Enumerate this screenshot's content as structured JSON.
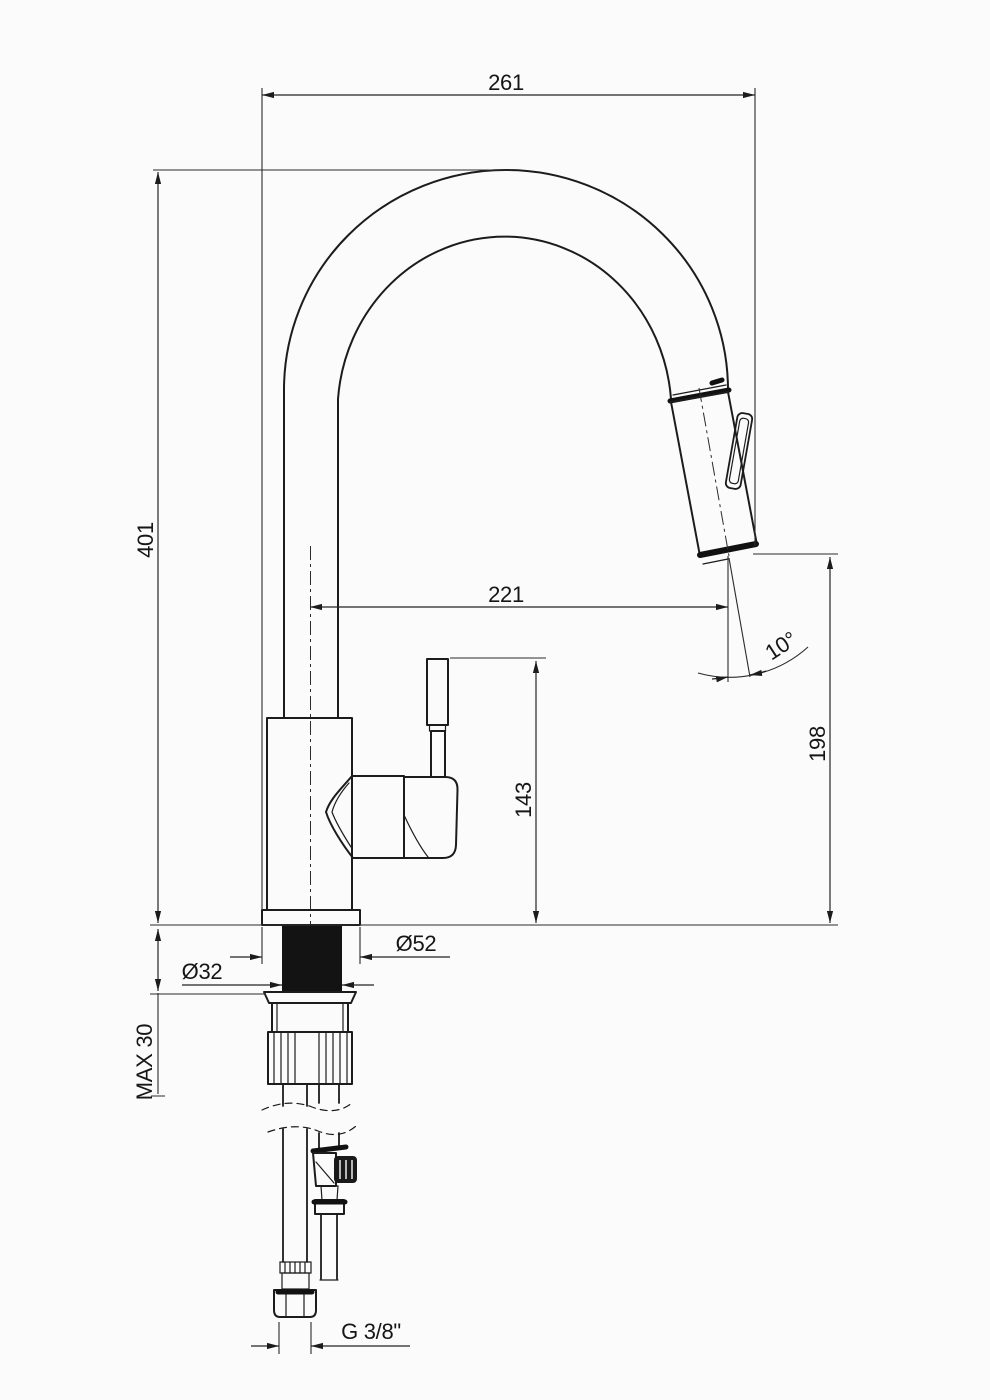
{
  "drawing": {
    "title": "Kitchen faucet with pull-out spray — dimensioned technical drawing",
    "units": "mm",
    "dimensions": {
      "overall_reach": "261",
      "overall_height": "401",
      "center_to_outlet_reach": "221",
      "handle_top_height": "143",
      "outlet_height": "198",
      "spray_angle": "10°",
      "base_flange_diameter": "Ø52",
      "mounting_hole_diameter": "Ø32",
      "max_counter_thickness": "MAX 30",
      "supply_thread": "G 3/8\""
    },
    "components": [
      "spout-arc-tube",
      "pull-out-spray-head",
      "spray-head-button",
      "faucet-body",
      "lever-handle",
      "handle-cone-joint",
      "base-flange",
      "rubber-gasket",
      "mounting-washer",
      "knurled-mounting-nut",
      "flexible-supply-hose",
      "hose-crimp-fitting",
      "hose-hex-nut",
      "rigid-supply-pipe",
      "shut-off-valve",
      "break-lines",
      "countertop-line"
    ],
    "colors": {
      "background": "#fbfbfb",
      "line": "#1c1c1c",
      "gasket_fill": "#131313",
      "dimension_line": "#242424"
    }
  }
}
